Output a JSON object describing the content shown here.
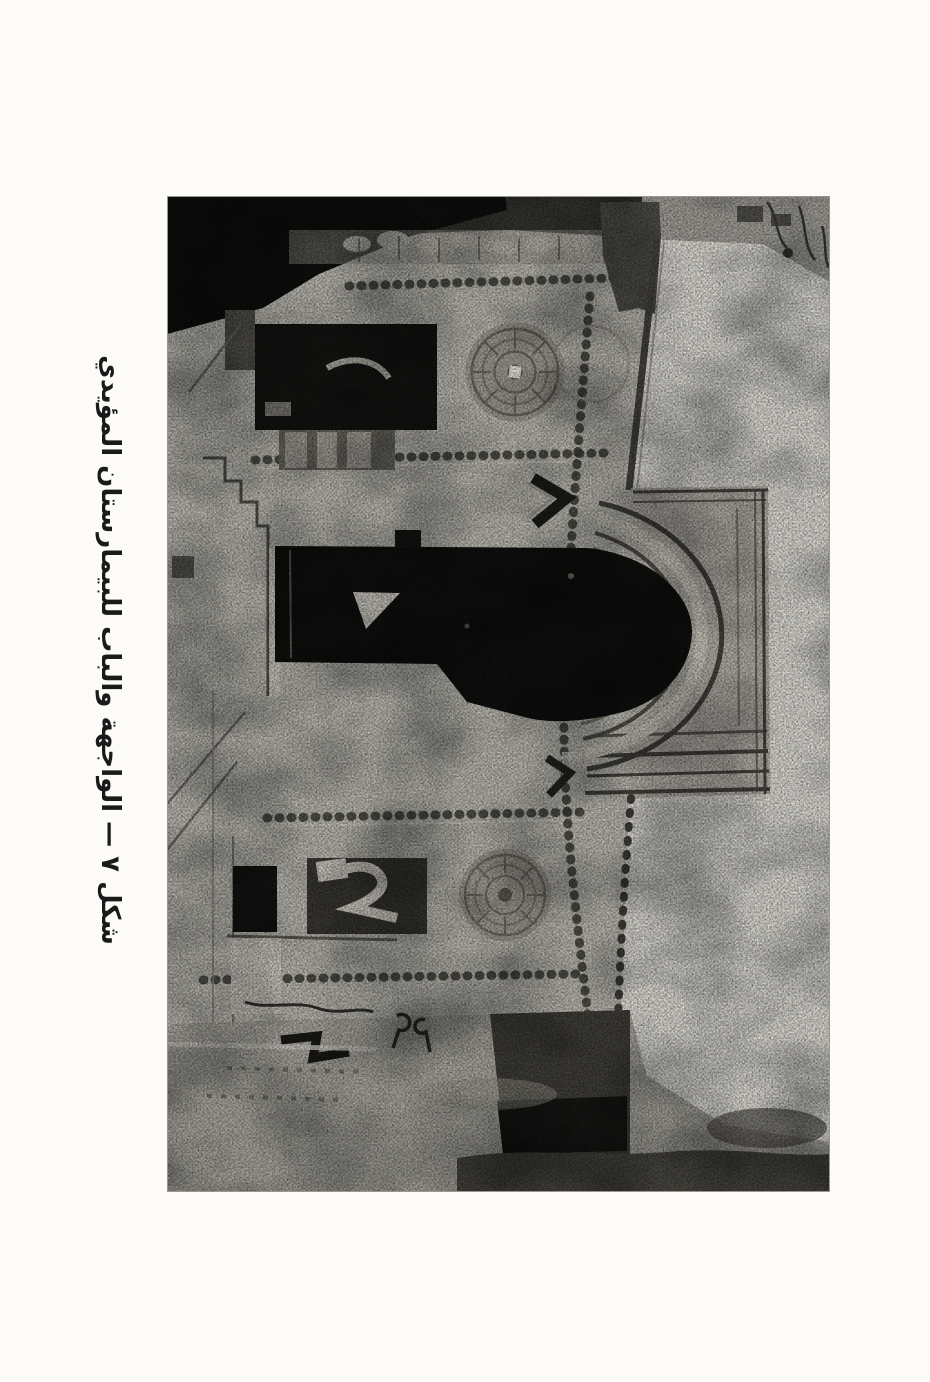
{
  "page": {
    "kind": "scanned-book-plate",
    "background_color": "#fcfbf8"
  },
  "figure": {
    "caption": "شكل ٧ — الواجهة والباب للبيمارستان المؤيدي",
    "label": "شكل ٧",
    "title": "الواجهة والباب للبيمارستان المؤيدي",
    "caption_orientation": "rotated-90-clockwise"
  },
  "photo": {
    "kind": "halftone-photograph",
    "printed_rotation": "rotated-90-on-page",
    "subject": "Stone facade and entrance portal with large dark horseshoe arch, carved roundels, chain moldings, windows and rubble foreground; sky along right edge",
    "palette": {
      "wall": "#bab8b0",
      "sky": "#dedcd5",
      "deep_shadow": "#0e0e0d",
      "foreground": "#a8a69e",
      "ink": "#1a1a1a"
    }
  }
}
